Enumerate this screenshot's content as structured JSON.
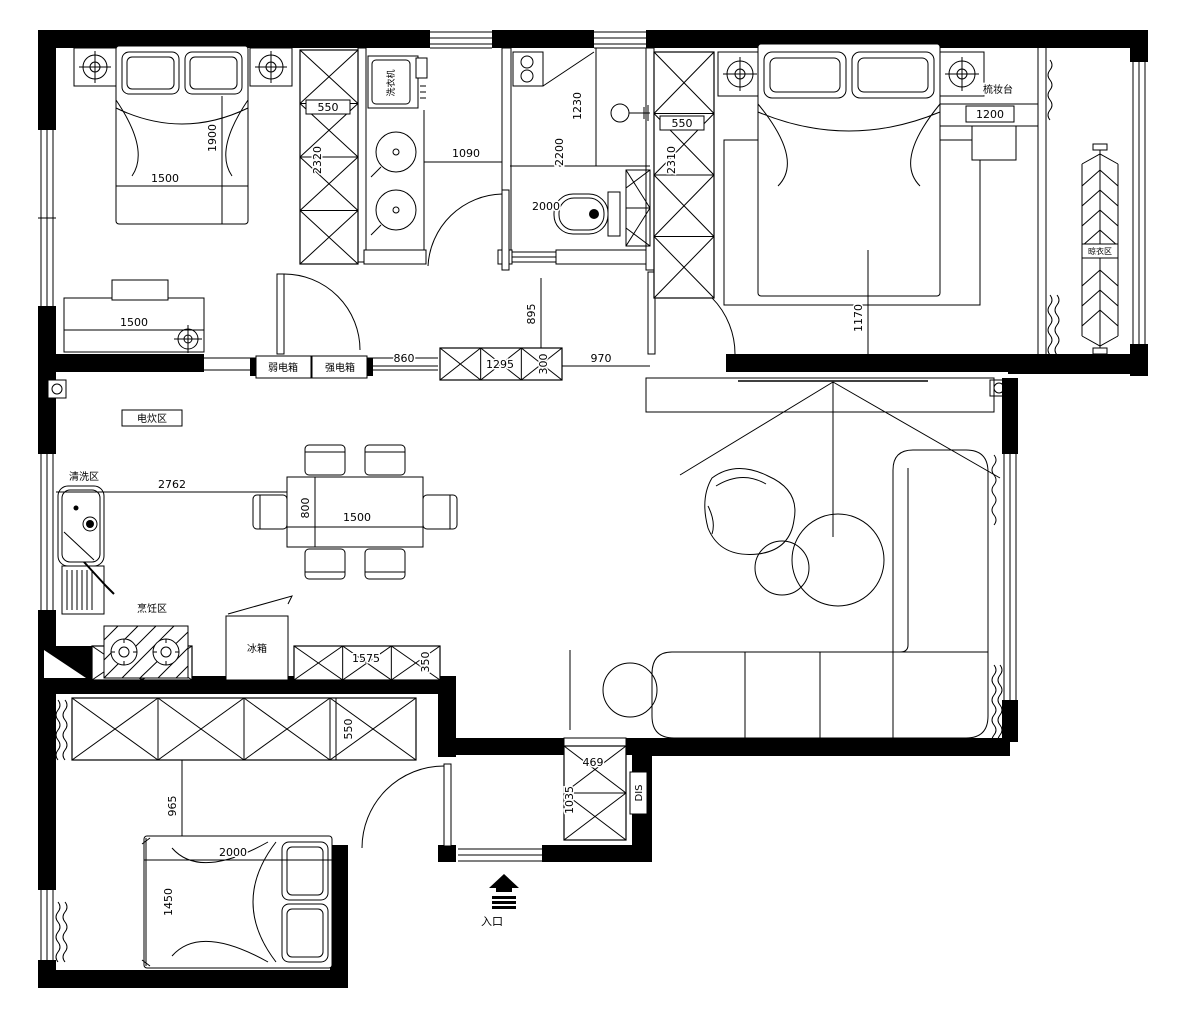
{
  "drawing": {
    "type": "apartment floor plan",
    "colors": {
      "line": "#000000",
      "wall": "#000000",
      "background": "#ffffff"
    }
  },
  "labels": {
    "washing_machine": "洗衣机",
    "dressing_table": "梳妆台",
    "drying_area": "晾衣区",
    "weak_current_box": "弱电箱",
    "strong_current_box": "强电箱",
    "electric_cooking_area": "电炊区",
    "washing_area": "清洗区",
    "cooking_area": "烹饪区",
    "fridge": "冰箱",
    "dis": "DIS",
    "entrance": "入口"
  },
  "dims": {
    "bed1_width": "1500",
    "bed1_length": "1900",
    "wardrobe1_depth": "550",
    "wardrobe1_length": "2320",
    "laundry_width": "1090",
    "bath_shower": "1230",
    "bath_depth": "2200",
    "bath_width": "2000",
    "wardrobe2_depth": "550",
    "wardrobe2_length": "2310",
    "dresser_width": "1200",
    "bed2_side": "1170",
    "desk_width": "1500",
    "hall_a": "860",
    "hall_cabinet": "1295",
    "hall_cabinet_depth": "300",
    "hall_b": "970",
    "hall_c": "895",
    "kitchen_span": "2762",
    "table_depth": "800",
    "table_width": "1500",
    "cabinet2_width": "1575",
    "cabinet2_depth": "350",
    "wardrobe3_depth": "550",
    "room3_gap": "965",
    "bed3_length": "2000",
    "bed3_width": "1450",
    "entry_cabinet_w": "469",
    "entry_cabinet_h": "1035"
  }
}
